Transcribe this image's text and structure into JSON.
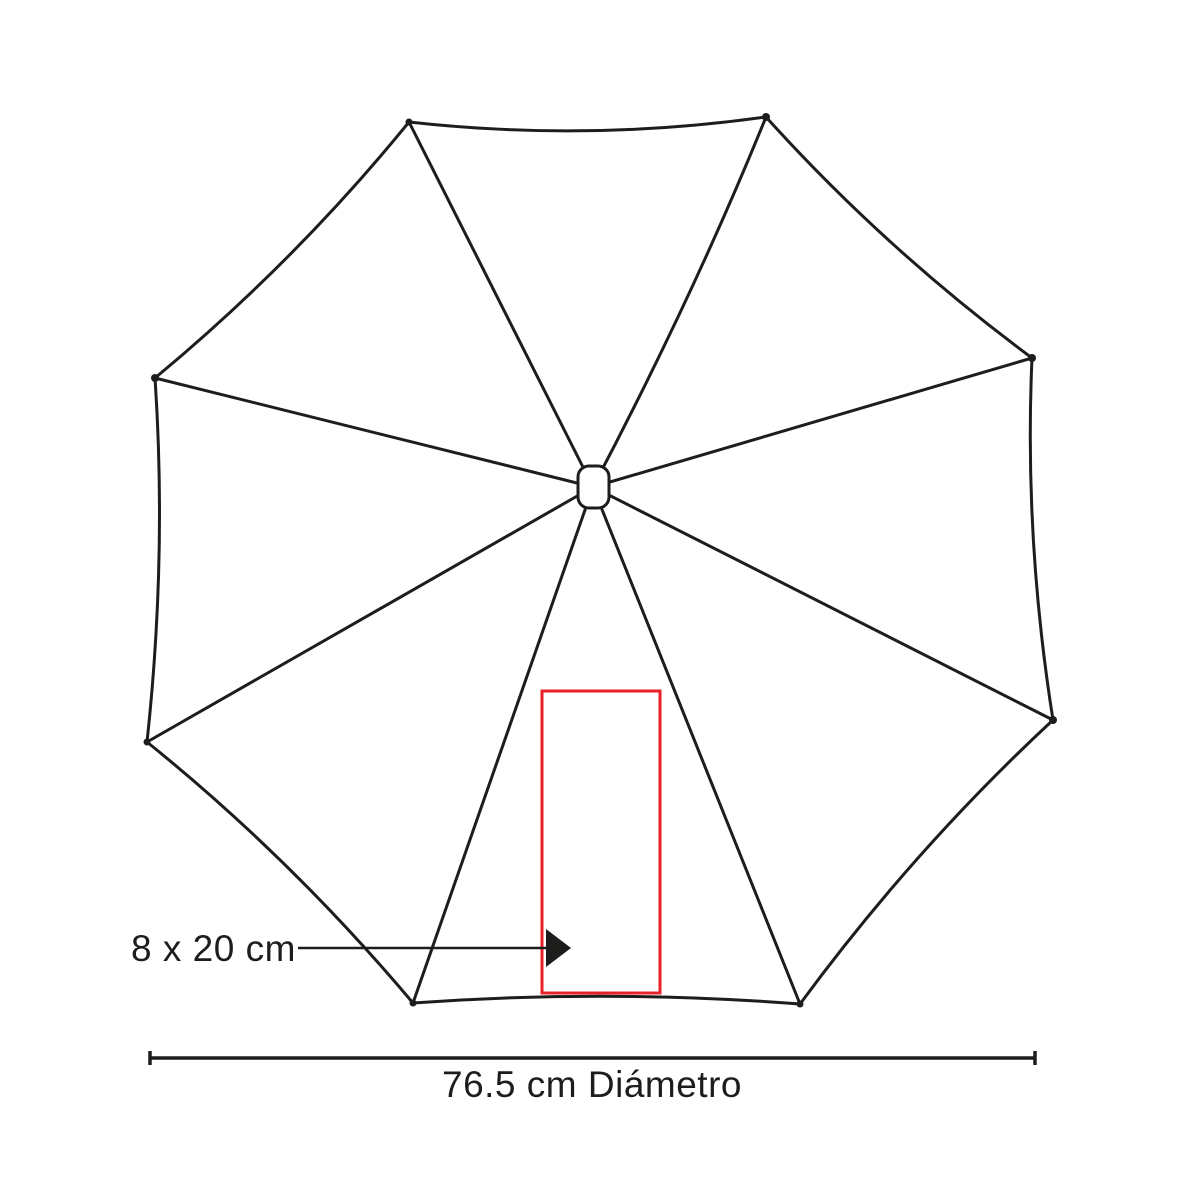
{
  "diagram": {
    "type": "umbrella-top-view-imprint-diagram",
    "labels": {
      "print_area": "8 x 20 cm",
      "diameter": "76.5 cm Diámetro"
    },
    "colors": {
      "outline": "#1d1d1b",
      "print_area_box": "#e8202a",
      "background": "#ffffff"
    },
    "measurements": {
      "print_area_cm": "8 x 20",
      "diameter_cm": "76.5"
    }
  }
}
